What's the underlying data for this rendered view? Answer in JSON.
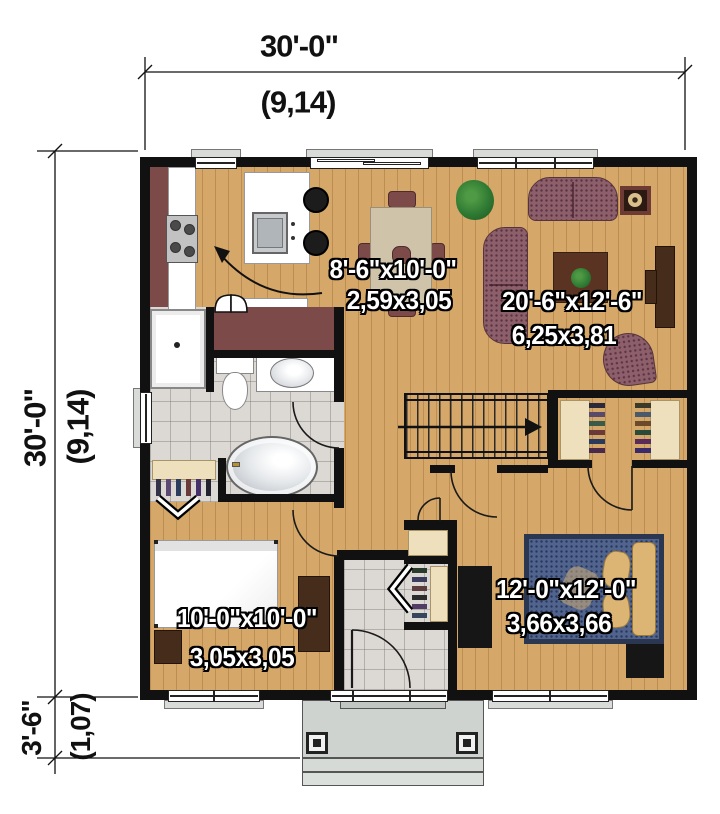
{
  "title": "Two-bedroom house first floor plan",
  "dimensions": {
    "top": {
      "imperial": "30'-0\"",
      "metric": "(9,14)"
    },
    "left": {
      "imperial": "30'-0\"",
      "metric": "(9,14)"
    },
    "porch": {
      "imperial": "3'-6\"",
      "metric": "(1,07)"
    }
  },
  "rooms": {
    "kitchen_dining": {
      "imperial": "8'-6\"x10'-0\"",
      "metric": "2,59x3,05"
    },
    "living": {
      "imperial": "20'-6\"x12'-6\"",
      "metric": "6,25x3,81"
    },
    "bedroom": {
      "imperial": "10'-0\"x10'-0\"",
      "metric": "3,05x3,05"
    },
    "master_bedroom": {
      "imperial": "12'-0\"x12'-0\"",
      "metric": "3,66x3,66"
    }
  },
  "colors": {
    "wall": "#111111",
    "wood": "#d5a768",
    "tile": "#dcd8d4",
    "maroon": "#7d4a4a",
    "sofa": "#8d5f6a",
    "bed_blue": "#51648e",
    "tan": "#dcb473",
    "dark_wood": "#452c1b",
    "black_furniture": "#161616",
    "closet_beige": "#eee0bd",
    "plant_green": "#2f7a33",
    "table_beige": "#cfc3a9",
    "coffee_table": "#5a3322",
    "porch": "#cfd3cf"
  }
}
